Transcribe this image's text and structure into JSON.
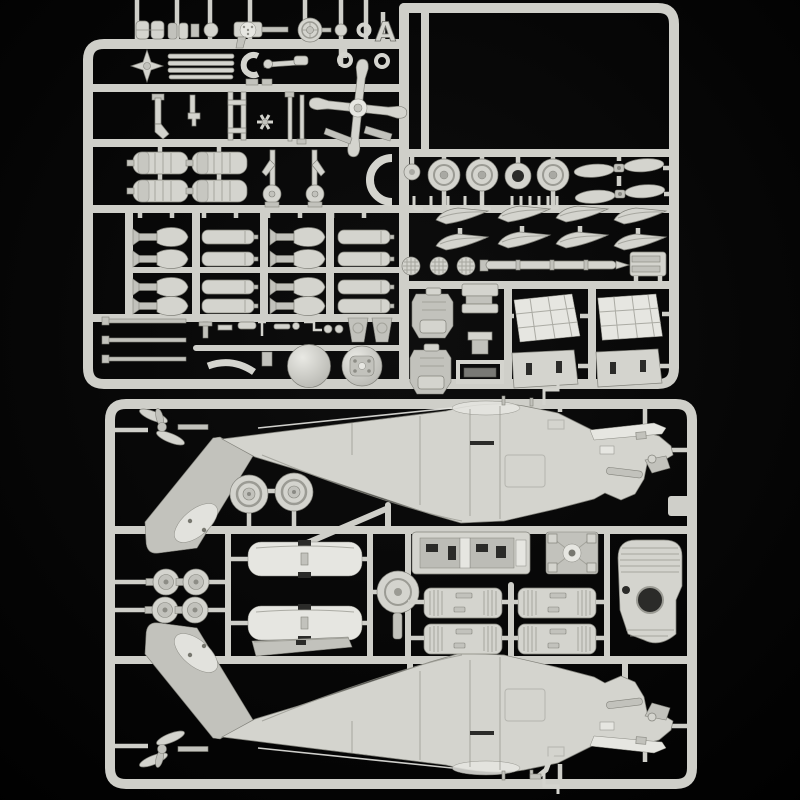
{
  "scene": {
    "description": "Photograph of two light-grey injection-moulded polystyrene model kit sprues with helicopter parts, shot on a black background",
    "colors": {
      "background": "#050505",
      "plastic": "#d4d4ce",
      "plastic_bright": "#e6e6e1",
      "plastic_mid": "#c2c2bc",
      "plastic_shadow": "#97978f",
      "plastic_edge": "#82827b",
      "runner": "#cfcfc9",
      "slot_dark": "#2b2b29"
    }
  },
  "sprues": {
    "top": {
      "letter": "A",
      "groups": [
        {
          "label": "main-rotor-blades",
          "count": 4
        },
        {
          "label": "road-wheels",
          "count": 5
        },
        {
          "label": "tail-rotor-paddle-pairs",
          "count": 2
        },
        {
          "label": "ribbed-rocket-pods",
          "count": 4
        },
        {
          "label": "hellfire-missiles",
          "count": 8
        },
        {
          "label": "rocket-tubes",
          "count": 8
        },
        {
          "label": "main-rotor-head",
          "count": 1
        },
        {
          "label": "wing-pylons",
          "count": 8
        },
        {
          "label": "pilot-seats",
          "count": 2
        },
        {
          "label": "engine-cowling-panels",
          "count": 4
        },
        {
          "label": "rotor-hub-domes",
          "count": 2
        },
        {
          "label": "antenna-rods",
          "count": 3
        },
        {
          "label": "small-fittings",
          "count": 40
        }
      ]
    },
    "bottom": {
      "groups": [
        {
          "label": "upper-fuselage-half",
          "count": 1
        },
        {
          "label": "lower-fuselage-half",
          "count": 1
        },
        {
          "label": "stub-wing-skins",
          "count": 2
        },
        {
          "label": "engine-intakes",
          "count": 2
        },
        {
          "label": "wheel-hubs",
          "count": 4
        },
        {
          "label": "cockpit-tub",
          "count": 1
        },
        {
          "label": "main-gearbox",
          "count": 1
        },
        {
          "label": "engine-nacelle-panel",
          "count": 1
        },
        {
          "label": "engine-access-cowls",
          "count": 4
        },
        {
          "label": "rotor-hub-disc",
          "count": 1
        },
        {
          "label": "horizontal-stabilizer",
          "count": 1
        },
        {
          "label": "tail-skid",
          "count": 1
        }
      ]
    }
  }
}
